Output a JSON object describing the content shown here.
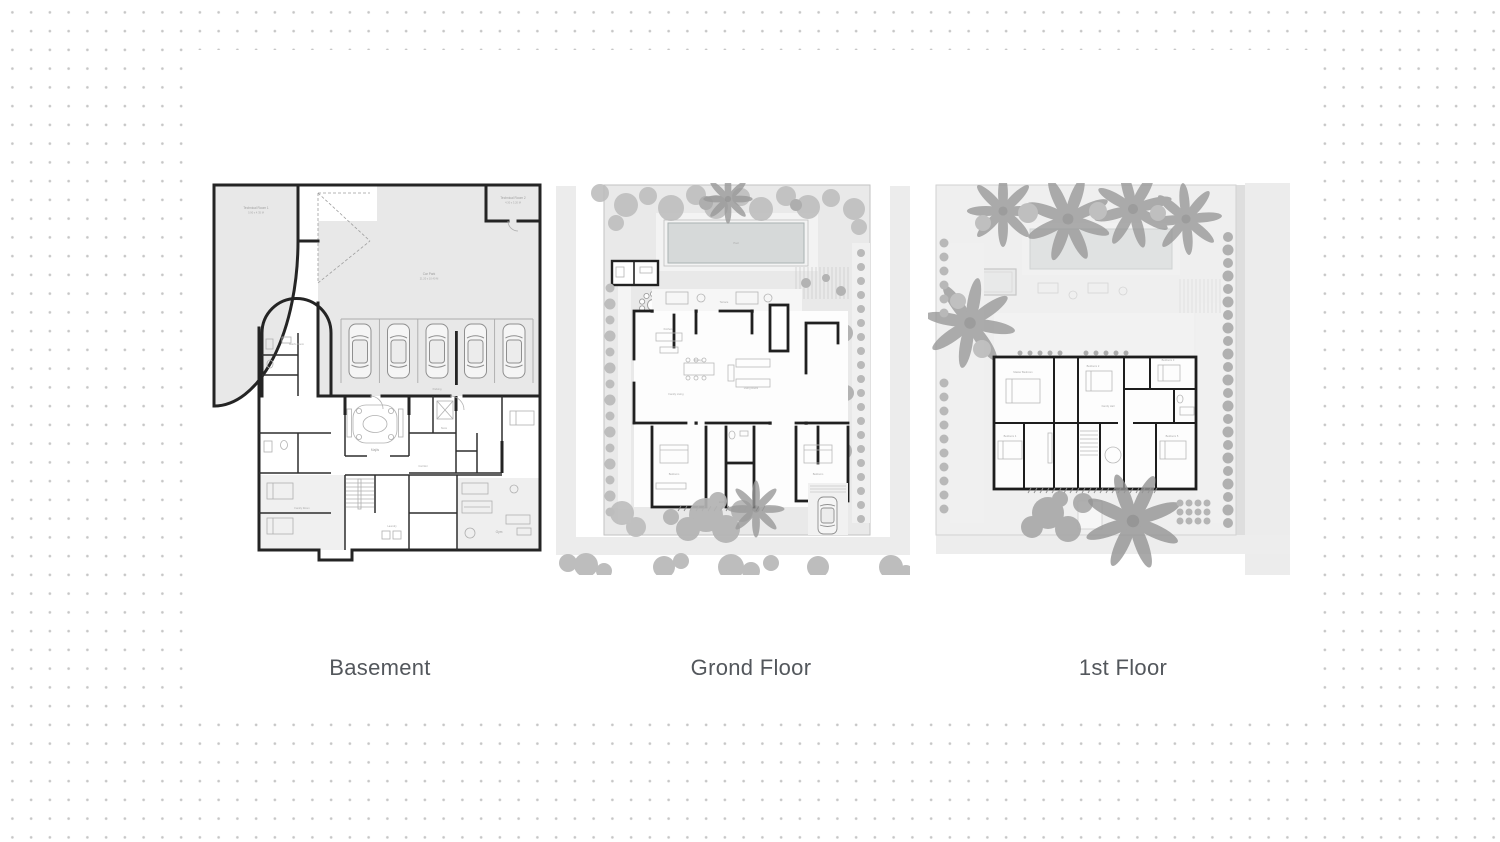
{
  "captions": {
    "basement": "Basement",
    "ground": "Grond Floor",
    "first": "1st Floor"
  },
  "colors": {
    "dot": "#c6c6c6",
    "wall": "#242424",
    "site_fill": "#e9e9e9",
    "pool_fill": "#d6d9d9",
    "tree": "#b5b5b5",
    "caption_text": "#53575c"
  },
  "basement": {
    "labels": {
      "tech1": "Technical Room 1",
      "tech1_dim": "5.90 x 4.35 M",
      "tech2": "Technical Room 2",
      "tech2_dim": "4.30 x 3.20 M",
      "carpark": "Car Park",
      "carpark_dim": "21.20 x 10.40 M",
      "maids": "Maid's Room",
      "majlis": "Majlis",
      "corridor": "Corridor",
      "gym": "Gym",
      "laundry": "Laundry",
      "family": "Family Room",
      "store": "Store",
      "stairs": "Stairs",
      "parking": "Parking"
    }
  },
  "ground": {
    "labels": {
      "pool": "Pool",
      "terrace": "Terrace",
      "outdoor_dining": "Outdoor Dining",
      "living": "Living Room",
      "dining": "Dining",
      "kitchen": "Kitchen",
      "family_living": "Family Living",
      "bedroom1": "Bedroom",
      "bedroom2": "Bedroom",
      "entry": "Entry"
    }
  },
  "first": {
    "labels": {
      "master": "Master Bedroom",
      "bed2": "Bedroom 2",
      "bed3": "Bedroom 3",
      "bed4": "Bedroom 4",
      "bed5": "Bedroom 5",
      "hall": "Family Hall"
    }
  }
}
